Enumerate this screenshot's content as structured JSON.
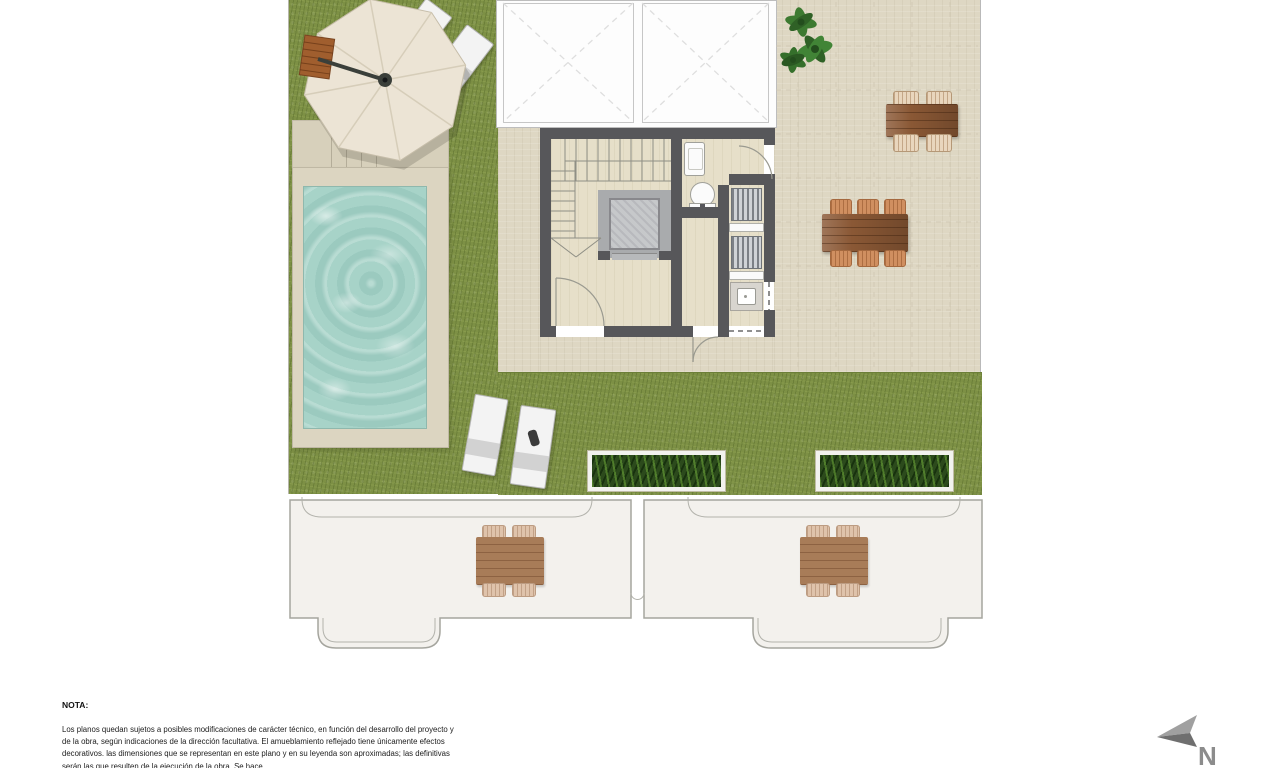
{
  "document": {
    "kind": "residential roof-terrace floor plan",
    "visible_text_language": "Spanish"
  },
  "note": {
    "title": "NOTA:",
    "body": "Los planos quedan sujetos a posibles modificaciones de carácter técnico, en función del desarrollo del proyecto y de la obra, según indicaciones de la dirección facultativa. El amueblamiento reflejado tiene únicamente efectos decorativos. las dimensiones que se representan en este plano y en su leyenda son aproximadas; las definitivas serán las que resulten de la ejecución de la obra. Se hace"
  },
  "compass": {
    "label": "N"
  },
  "colors": {
    "grass": "#7d9045",
    "terrace": "#ded7c3",
    "wall": "#57575a",
    "pool_water": "#a7d3c8",
    "pool_deck": "#dcd5c1",
    "wood_furniture": "#8a5835",
    "planter_green": "#2c4a1c",
    "lower_level_fill": "#f3f1ed",
    "umbrella_canvas": "#ece4d5",
    "compass_gray": "#8c8c8c"
  },
  "plan_elements": [
    "lawn",
    "swimming-pool",
    "parasol",
    "side-table",
    "sun-loungers",
    "skylights",
    "staircase",
    "elevator",
    "washbasin",
    "toilet",
    "outdoor-kitchen-louvers",
    "kitchen-sink",
    "tiled-terrace",
    "potted-plant",
    "dining-table-4-seats",
    "dining-table-6-seats",
    "planters",
    "lower-floor-terraces",
    "north-arrow"
  ]
}
